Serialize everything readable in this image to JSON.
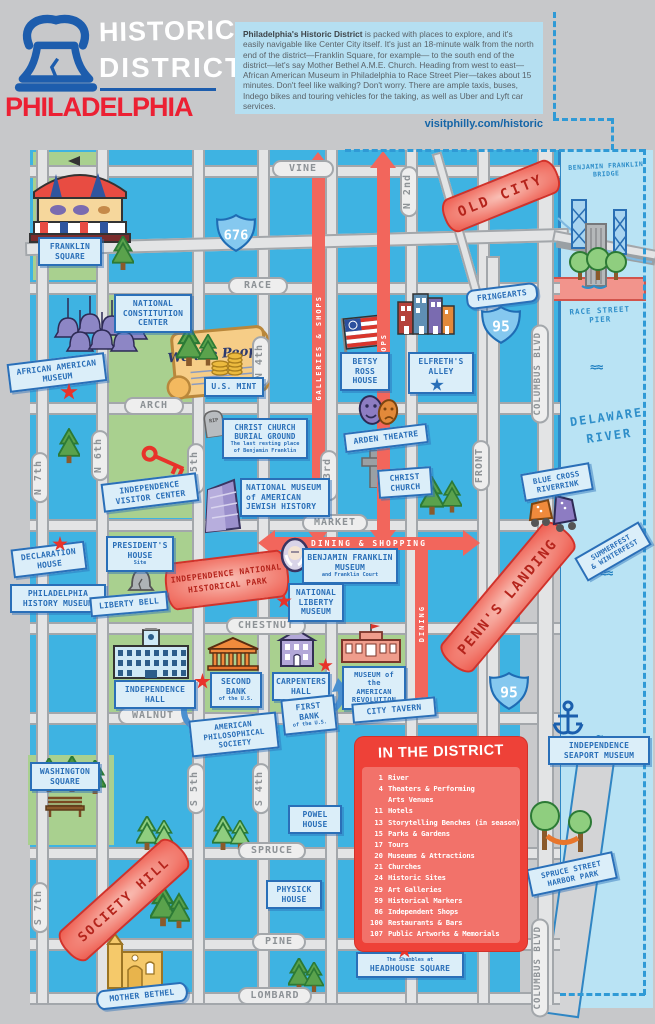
{
  "header": {
    "brand_line1": "HISTORIC",
    "brand_line2": "DISTRICT",
    "brand_city": "PHILADELPHIA",
    "intro_bold": "Philadelphia's Historic District",
    "intro_rest": " is packed with places to explore, and it's easily navigable like Center City itself. It's just an 18-minute walk from the north end of the district—Franklin Square, for example— to the south end of the district—let's say Mother Bethel A.M.E. Church. Heading from west to east—African American Museum in Philadelphia to Race Street Pier—takes about 15 minutes. Don't feel like walking? Don't worry. There are ample taxis, buses, Indego bikes and touring vehicles for the taking, as well as Uber and Lyft car services.",
    "url": "visitphilly.com/historic"
  },
  "streets": {
    "vine": "VINE",
    "race": "RACE",
    "arch": "ARCH",
    "market": "MARKET",
    "chestnut": "CHESTNUT",
    "walnut": "WALNUT",
    "spruce": "SPRUCE",
    "pine": "PINE",
    "lombard": "LOMBARD",
    "n7": "N 7th",
    "n6": "N 6th",
    "n5": "N 5th",
    "n4": "N 4th",
    "n3": "N 3rd",
    "n2": "N 2nd",
    "front": "FRONT",
    "columbus": "COLUMBUS BLVD",
    "columbus_s": "COLUMBUS BLVD",
    "s7": "S 7th",
    "s5": "S 5th",
    "s4": "S 4th"
  },
  "highways": {
    "i676": "676",
    "i95": "95"
  },
  "arrows": {
    "galleries": "GALLERIES & SHOPS",
    "shops": "SHOPS",
    "dining_shopping": "DINING & SHOPPING",
    "dining": "DINING"
  },
  "districts": {
    "old_city": "OLD CITY",
    "penns_landing": "PENN'S LANDING",
    "society_hill": "SOCIETY HILL",
    "inhp": "INDEPENDENCE NATIONAL\nHISTORICAL PARK"
  },
  "water": {
    "river": "DELAWARE\nRIVER",
    "bridge": "BENJAMIN FRANKLIN\nBRIDGE",
    "race_pier": "RACE STREET PIER"
  },
  "landmarks": {
    "franklin_square": "FRANKLIN\nSQUARE",
    "constitution": "NATIONAL\nCONSTITUTION\nCENTER",
    "african_american": "AFRICAN AMERICAN\nMUSEUM",
    "us_mint": "U.S. MINT",
    "rip": "RIP",
    "burial_ground": "CHRIST CHURCH\nBURIAL GROUND",
    "burial_ground_sub": "The last resting place of Benjamin Franklin",
    "betsy_ross": "BETSY\nROSS\nHOUSE",
    "elfreths": "ELFRETH'S\nALLEY",
    "fringearts": "FRINGEARTS",
    "arden": "ARDEN THEATRE",
    "christ_church": "CHRIST\nCHURCH",
    "visitor_center": "INDEPENDENCE\nVISITOR CENTER",
    "nmajh": "NATIONAL MUSEUM of AMERICAN JEWISH HISTORY",
    "presidents_house": "PRESIDENT'S\nHOUSE",
    "presidents_house_sub": "Site",
    "declaration": "DECLARATION\nHOUSE",
    "history_museum": "PHILADELPHIA\nHISTORY MUSEUM",
    "liberty_bell": "LIBERTY BELL",
    "bfm": "BENJAMIN FRANKLIN\nMUSEUM",
    "bfm_sub": "and Franklin Court",
    "nlm": "NATIONAL\nLIBERTY\nMUSEUM",
    "independence_hall": "INDEPENDENCE\nHALL",
    "second_bank": "SECOND\nBANK",
    "second_bank_sub": "of the U.S.",
    "carpenters": "CARPENTERS'\nHALL",
    "moar": "MUSEUM of the\nAMERICAN\nREVOLUTION",
    "aps": "AMERICAN\nPHILOSOPHICAL\nSOCIETY",
    "first_bank": "FIRST\nBANK",
    "first_bank_sub": "of the U.S.",
    "city_tavern": "CITY TAVERN",
    "washington_square": "WASHINGTON\nSQUARE",
    "powel": "POWEL\nHOUSE",
    "physick": "PHYSICK\nHOUSE",
    "headhouse": "HEADHOUSE SQUARE",
    "headhouse_sup": "The Shambles at",
    "mother_bethel": "MOTHER BETHEL",
    "riverrink": "BLUE CROSS\nRIVERRINK",
    "summerfest": "SUMMERFEST\n& WINTERFEST",
    "seaport": "INDEPENDENCE\nSEAPORT MUSEUM",
    "harbor_park": "SPRUCE STREET\nHARBOR PARK"
  },
  "legend": {
    "title": "IN THE DISTRICT",
    "items": [
      {
        "count": "1",
        "label": "River"
      },
      {
        "count": "4",
        "label": "Theaters & Performing\nArts Venues"
      },
      {
        "count": "11",
        "label": "Hotels"
      },
      {
        "count": "13",
        "label": "Storytelling Benches (in season)"
      },
      {
        "count": "15",
        "label": "Parks & Gardens"
      },
      {
        "count": "17",
        "label": "Tours"
      },
      {
        "count": "20",
        "label": "Museums & Attractions"
      },
      {
        "count": "21",
        "label": "Churches"
      },
      {
        "count": "24",
        "label": "Historic Sites"
      },
      {
        "count": "29",
        "label": "Art Galleries"
      },
      {
        "count": "59",
        "label": "Historical Markers"
      },
      {
        "count": "86",
        "label": "Independent Shops"
      },
      {
        "count": "100",
        "label": "Restaurants & Bars"
      },
      {
        "count": "107",
        "label": "Public Artworks & Memorials"
      }
    ]
  }
}
